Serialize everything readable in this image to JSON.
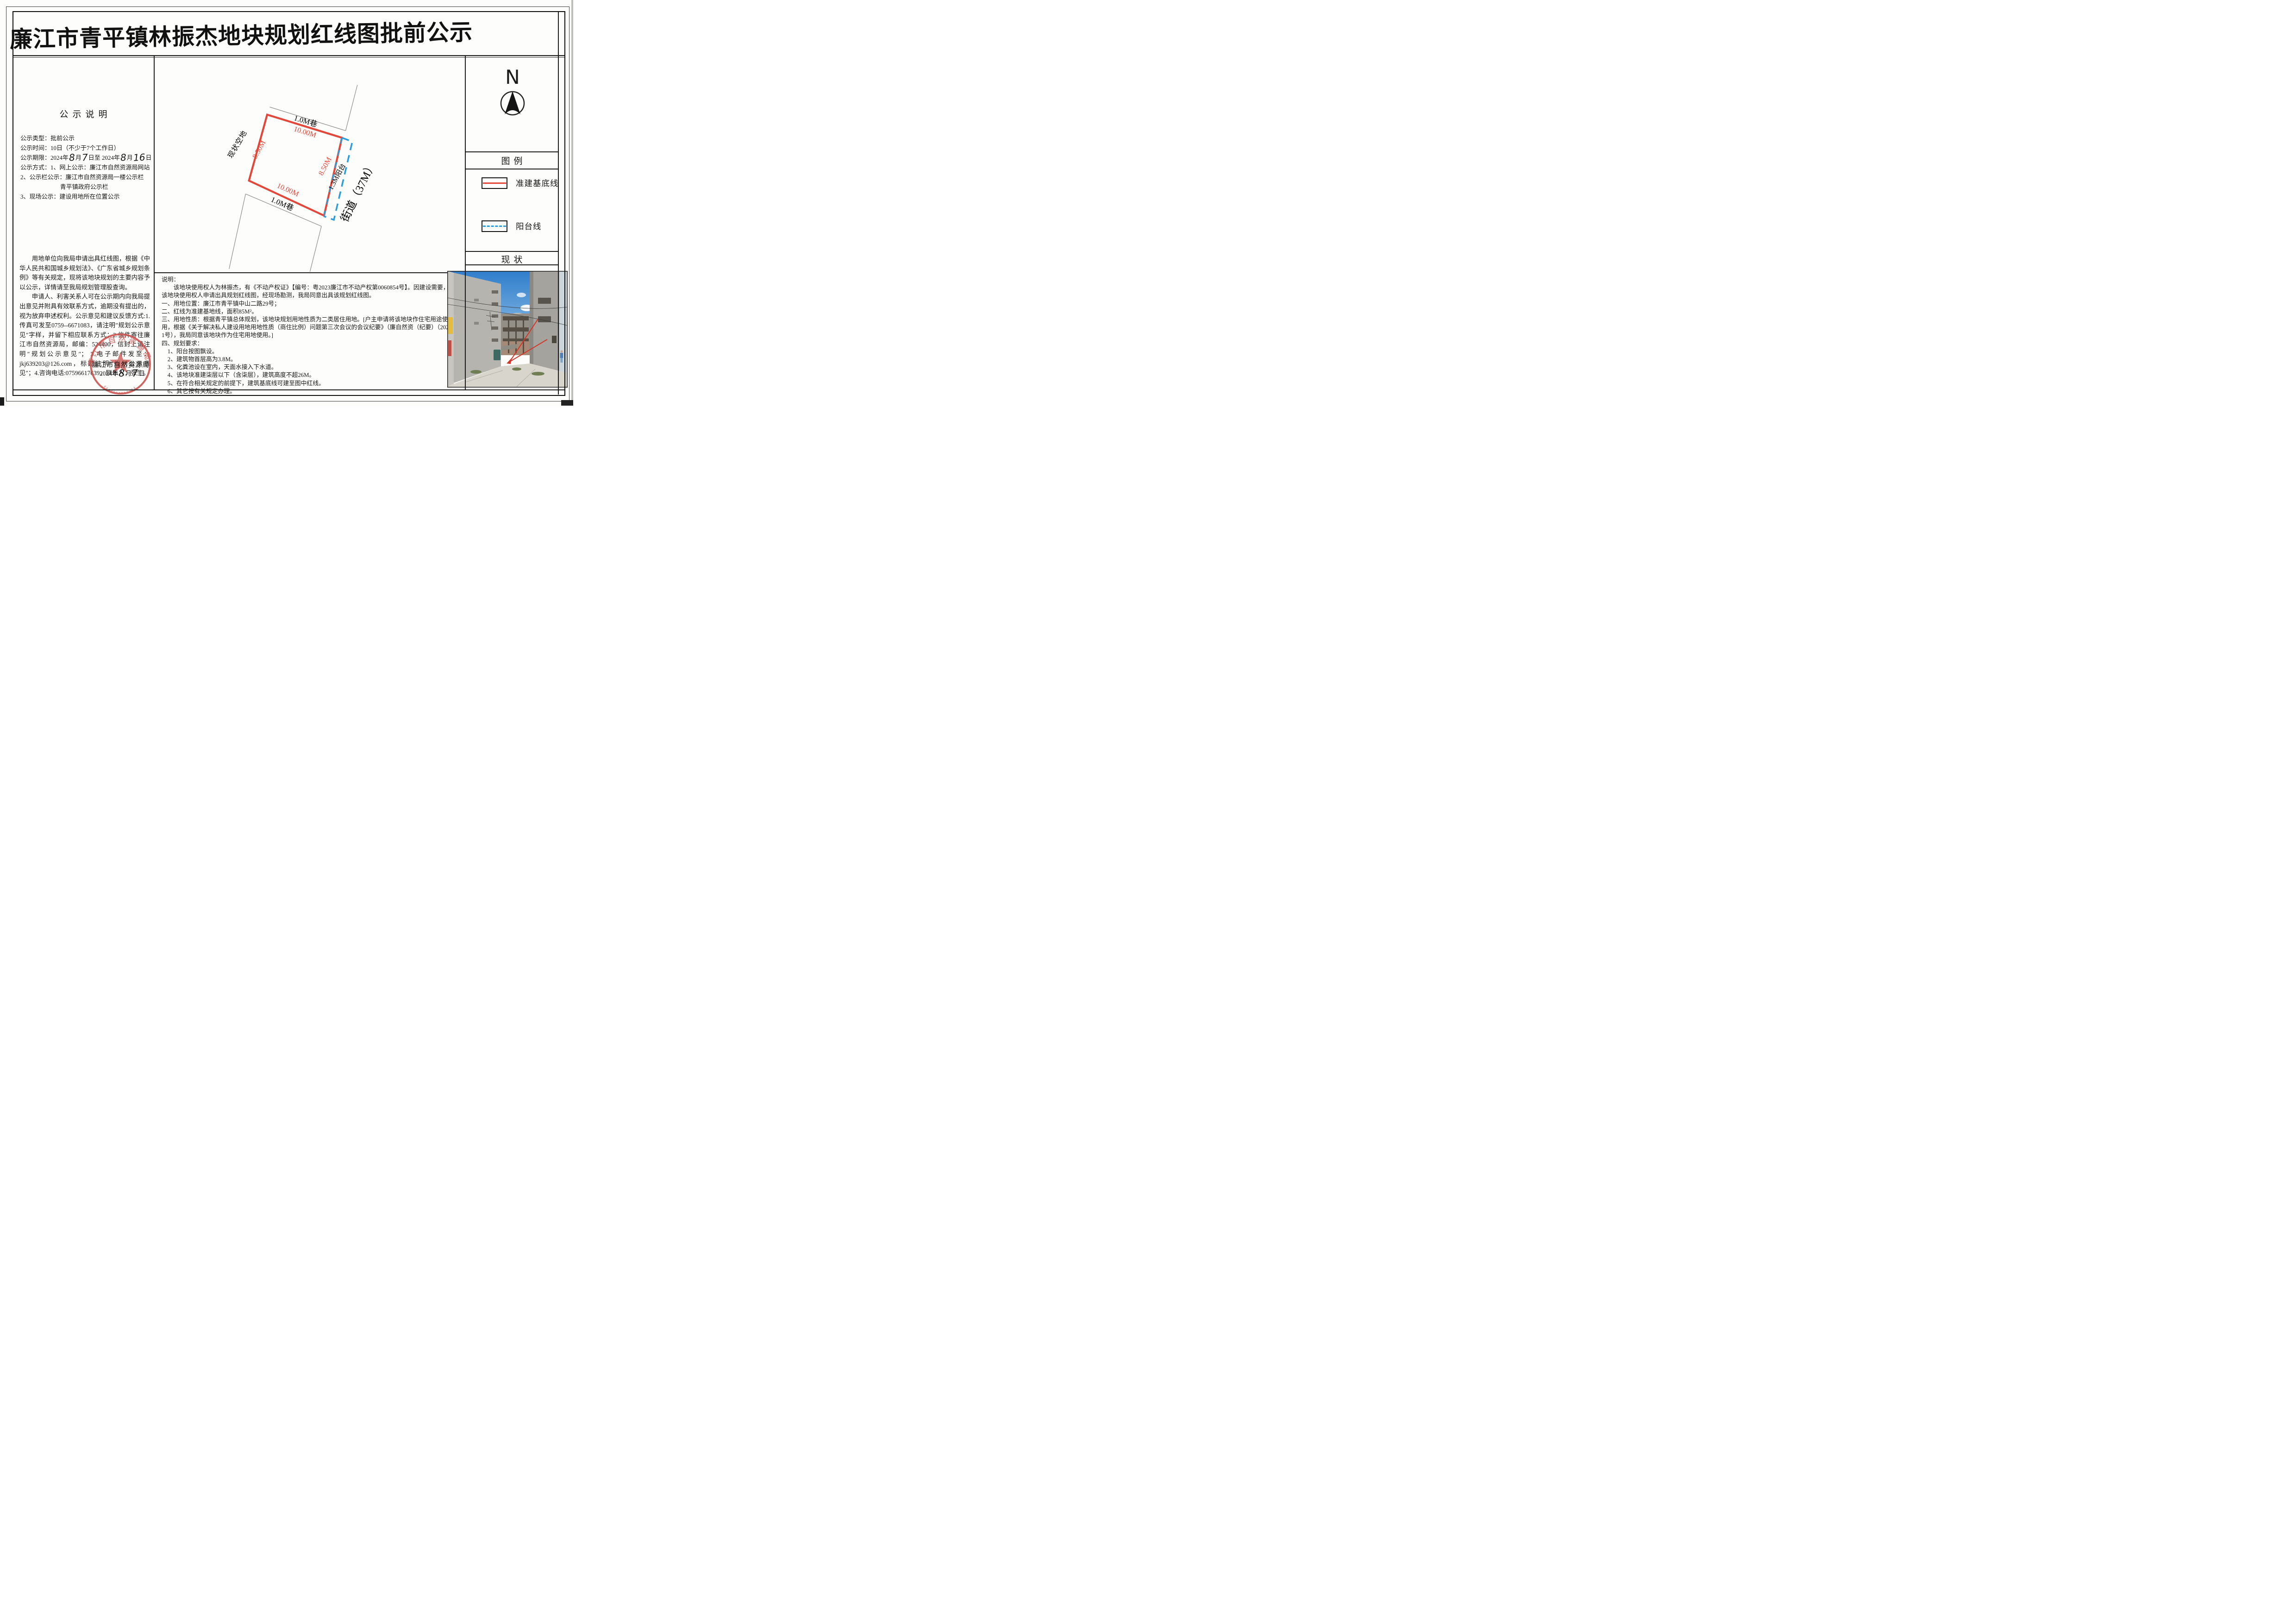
{
  "title": "廉江市青平镇林振杰地块规划红线图批前公示",
  "notice": {
    "heading": "公示说明",
    "line_type": "公示类型：批前公示",
    "line_time": "公示时间：10日（不少于7个工作日）",
    "period": {
      "p1": "公示期限：2024年",
      "m1": "8",
      "p2": "月",
      "d1": "7",
      "p3": "日至 2024年",
      "m2": "8",
      "p4": "月",
      "d2": "16",
      "p5": "日"
    },
    "line_method": "公示方式：1、网上公示：廉江市自然资源局网站",
    "line_board": "2、公示栏公示：廉江市自然资源局一楼公示栏",
    "line_board2": "青平镇政府公示栏",
    "line_site": "3、现场公示：建设用地所在位置公示",
    "para1": "用地单位向我局申请出具红线图，根据《中华人民共和国城乡规划法》、《广东省城乡规划条例》等有关规定，现将该地块规划的主要内容予以公示，详情请至我局规划管理股查询。",
    "para2": "申请人、利害关系人可在公示期内向我局提出意见并附具有效联系方式，逾期没有提出的，视为放弃申述权利。公示意见和建议反馈方式:1.传真可发至0759--6671083，请注明″规划公示意见″字样，并留下相应联系方式；2.信件寄往廉江市自然资源局，邮编：524400，信封上请注明″规划公示意见″； 3.电子邮件发至：jkj639203@126.com，标题注明″规划公示意见″；4.咨询电话:07596617639，联系人：张生。",
    "stamp": {
      "agency": "廉江市自然资源局",
      "date_p1": "2024年",
      "m": "8",
      "p2": "月",
      "d": "7",
      "p3": "日",
      "seal_ring_text": "廉江市自然资源局",
      "seal_code": "4408814052024"
    }
  },
  "plan": {
    "lane_top": "1.0M巷",
    "dim_top": "10.00M",
    "dim_left": "8.50M",
    "dim_right": "8.50M",
    "balcony_label": "1.3M阳台",
    "dim_bottom": "10.00M",
    "lane_bottom": "1.0M巷",
    "vacant_label": "现状空地",
    "street_label": "街道（37M）"
  },
  "desc": {
    "lines": [
      "说明：",
      "　　该地块使用权人为林振杰，有《不动产权证》【编号：粤2023廉江市不动产权第0060854号】。因建设需要，现该地块使用权人申请出具规划红线图，经现场勘测，我局同意出具该规划红线图。",
      "一、用地位置：廉江市青平镇中山二路29号；",
      "二、红线为准建基地线，面积85M²。",
      "三、用地性质：根据青平镇总体规划，该地块规划用地性质为二类居住用地。[户主申请将该地块作住宅用途使用，根据《关于解决私人建设用地用地性质（商住比例）问题第三次会议的会议纪要》（廉自然资（纪要）（2022）1号），我局同意该地块作为住宅用地使用。]",
      "四、规划要求：",
      "　1、阳台按图飘设。",
      "　2、建筑物首层高为3.8M。",
      "　3、化粪池设在室内，天面水接入下水道。",
      "　4、该地块准建柒层以下（含柒层），建筑高度不超26M。",
      "　5、在符合相关规定的前提下，建筑基底线可建至图中红线。",
      "　6、其它按有关规定办理。"
    ]
  },
  "right_panel": {
    "north_label": "N",
    "legend_heading": "图例",
    "legend": [
      {
        "label": "准建基底线",
        "style": "solid-red"
      },
      {
        "label": "阳台线",
        "style": "dashed-blue"
      }
    ],
    "status_heading": "现状"
  },
  "colors": {
    "redline": "#e2473a",
    "balcony_blue": "#2b9ddc",
    "seal_red": "#c9504c"
  }
}
